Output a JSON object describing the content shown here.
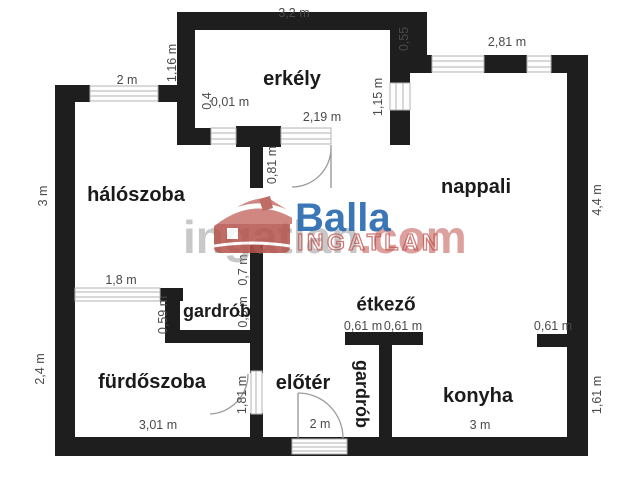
{
  "watermark": {
    "brand": "Balla",
    "brand_caps": "INGATLAN",
    "portal": "ingatlan",
    "portal_suffix": ".com"
  },
  "rooms": {
    "erkely": "erkély",
    "haloszoba": "hálószoba",
    "nappali": "nappali",
    "gardrob_felso": "gardrób",
    "furdoszoba": "fürdőszoba",
    "eloter": "előtér",
    "gardrob_also": "gardrób",
    "etkezo": "étkező",
    "konyha": "konyha"
  },
  "dimensions": {
    "erkely_felso": "3,2 m",
    "haloszoba_ablak": "2 m",
    "erkely_bal": "1,16 m",
    "erkely_jobb_eltolas": "0,55",
    "nappali_ablak": "2,81 m",
    "erkely_jobb_ablak": "1,15 m",
    "erkely_kis_ablak": "0,4",
    "erkely_kis_fal": "0,01 m",
    "erkely_also_ablak": "2,19 m",
    "erkely_ajto_fal": "0,81 m",
    "haloszoba_bal": "3 m",
    "nappali_jobb": "4,4 m",
    "furdoszoba_ablak": "1,8 m",
    "gardrob_bal_fal": "0,59 m",
    "valaszfal_felso": "0,7 m",
    "valaszfal_also": "0,6 m",
    "furdoszoba_bal": "2,4 m",
    "furdoszoba_ajto": "1,81 m",
    "furdoszoba_also": "3,01 m",
    "eloter_ajto": "2 m",
    "etkezo_fal_bal": "0,61 m",
    "etkezo_fal_jobb": "0,61 m",
    "konyha_fal": "0,61 m",
    "konyha_also": "3 m",
    "konyha_jobb": "1,61 m"
  },
  "colors": {
    "wall": "#1e1e1e",
    "brand_blue": "#2b6cb0",
    "brand_red": "#b5524c",
    "dimension_text": "#4a4a4a"
  }
}
